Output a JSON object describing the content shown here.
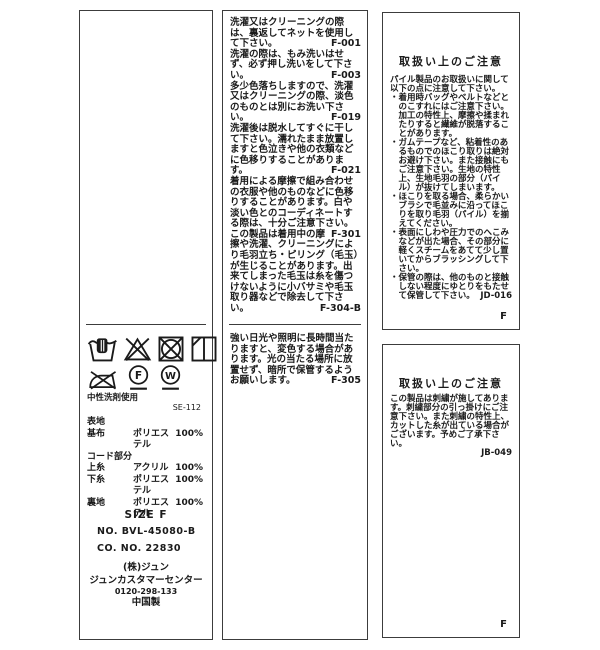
{
  "page": {
    "background": "#ffffff",
    "border_color": "#3c3c3c",
    "text_color": "#1a1a1a"
  },
  "middle_label": {
    "wash_notes": [
      {
        "text": "洗濯又はクリーニングの際は、裏返してネットを使用して下さい。",
        "code": "F-001"
      },
      {
        "text": "洗濯の際は、もみ洗いはせず、必ず押し洗いをして下さい。",
        "code": "F-003"
      },
      {
        "text": "多少色落ちしますので、洗濯又はクリーニングの際、淡色のものとは別にお洗い下さい。",
        "code": "F-019"
      },
      {
        "text": "洗濯後は脱水してすぐに干して下さい。濡れたまま放置しますと色泣きや他の衣類などに色移りすることがあります。",
        "code": "F-021"
      },
      {
        "text": "着用による摩擦で組み合わせの衣服や他のものなどに色移りすることがあります。白や淡い色とのコーディネートする際は、十分ご注意下さい。",
        "code": "F-301"
      },
      {
        "text": "この製品は着用中の摩擦や洗濯、クリーニングにより毛羽立ち・ピリング（毛玉）が生じることがあります。出来てしまった毛玉は糸を傷つけないように小バサミや毛玉取り器などで除去して下さい。",
        "code": "F-304-B"
      }
    ],
    "storage_note": {
      "text": "強い日光や照明に長時間当たりますと、変色する場合があります。光の当たる場所に放置せず、暗所で保管するようお願いします。",
      "code": "F-305"
    }
  },
  "care_label": {
    "symbols": [
      "hand-wash",
      "do-not-bleach",
      "do-not-tumble-dry",
      "line-dry-in-shade",
      "do-not-iron",
      "dry-clean-petroleum-solvent-gentle",
      "wet-clean-gentle"
    ],
    "drycleaning_letter": "F",
    "wetcleaning_letter": "W",
    "detergent_note": "中性洗剤使用",
    "code": "SE-112",
    "composition": [
      {
        "part": "表地",
        "material": "",
        "percent": ""
      },
      {
        "part": "基布",
        "material": "ポリエステル",
        "percent": "100%"
      },
      {
        "part": "コード部分",
        "material": "",
        "percent": ""
      },
      {
        "part": "上糸",
        "material": "アクリル",
        "percent": "100%"
      },
      {
        "part": "下糸",
        "material": "ポリエステル",
        "percent": "100%"
      },
      {
        "part": "裏地",
        "material": "ポリエステル",
        "percent": "100%"
      }
    ],
    "size": "SIZE F",
    "item_no": "NO. BVL-45080-B",
    "co_no": "CO. NO. 22830",
    "company": "(株)ジュン",
    "customer_center": "ジュンカスタマーセンター",
    "phone": "0120-298-133",
    "origin": "中国製"
  },
  "pile_care": {
    "heading": "取扱い上のご注意",
    "intro": "パイル製品のお取扱いに関して以下の点に注意して下さい。",
    "bullets": [
      {
        "text": "・着用時バッグやベルトなどとのこすれにはご注意下さい。加工の特性上、摩擦や揉まれたりすると繊維が脱落することがあります。",
        "code": ""
      },
      {
        "text": "・ガムテープなど、粘着性のあるものでのほこり取りは絶対お避け下さい。また接触にもご注意下さい。生地の特性上、生地毛羽の部分（パイル）が抜けてしまいます。",
        "code": ""
      },
      {
        "text": "・ほこりを取る場合、柔らかいブラシで毛並みに沿ってほこりを取り毛羽（パイル）を揃えてください。",
        "code": ""
      },
      {
        "text": "・表面にしわや圧力でのへこみなどが出た場合、その部分に軽くスチームをあてて少し置いてからブラッシングして下さい。",
        "code": ""
      },
      {
        "text": "・保管の際は、他のものと接触しない程度にゆとりをもたせて保管して下さい。",
        "code": "JD-016"
      }
    ],
    "footer": "F"
  },
  "embroidery_care": {
    "heading": "取扱い上のご注意",
    "text": "この製品は刺繍が施してあります。刺繍部分の引っ掛けにご注意下さい。また刺繍の特性上、カットした糸が出ている場合がございます。予めご了承下さい。",
    "code": "JB-049",
    "footer": "F"
  }
}
